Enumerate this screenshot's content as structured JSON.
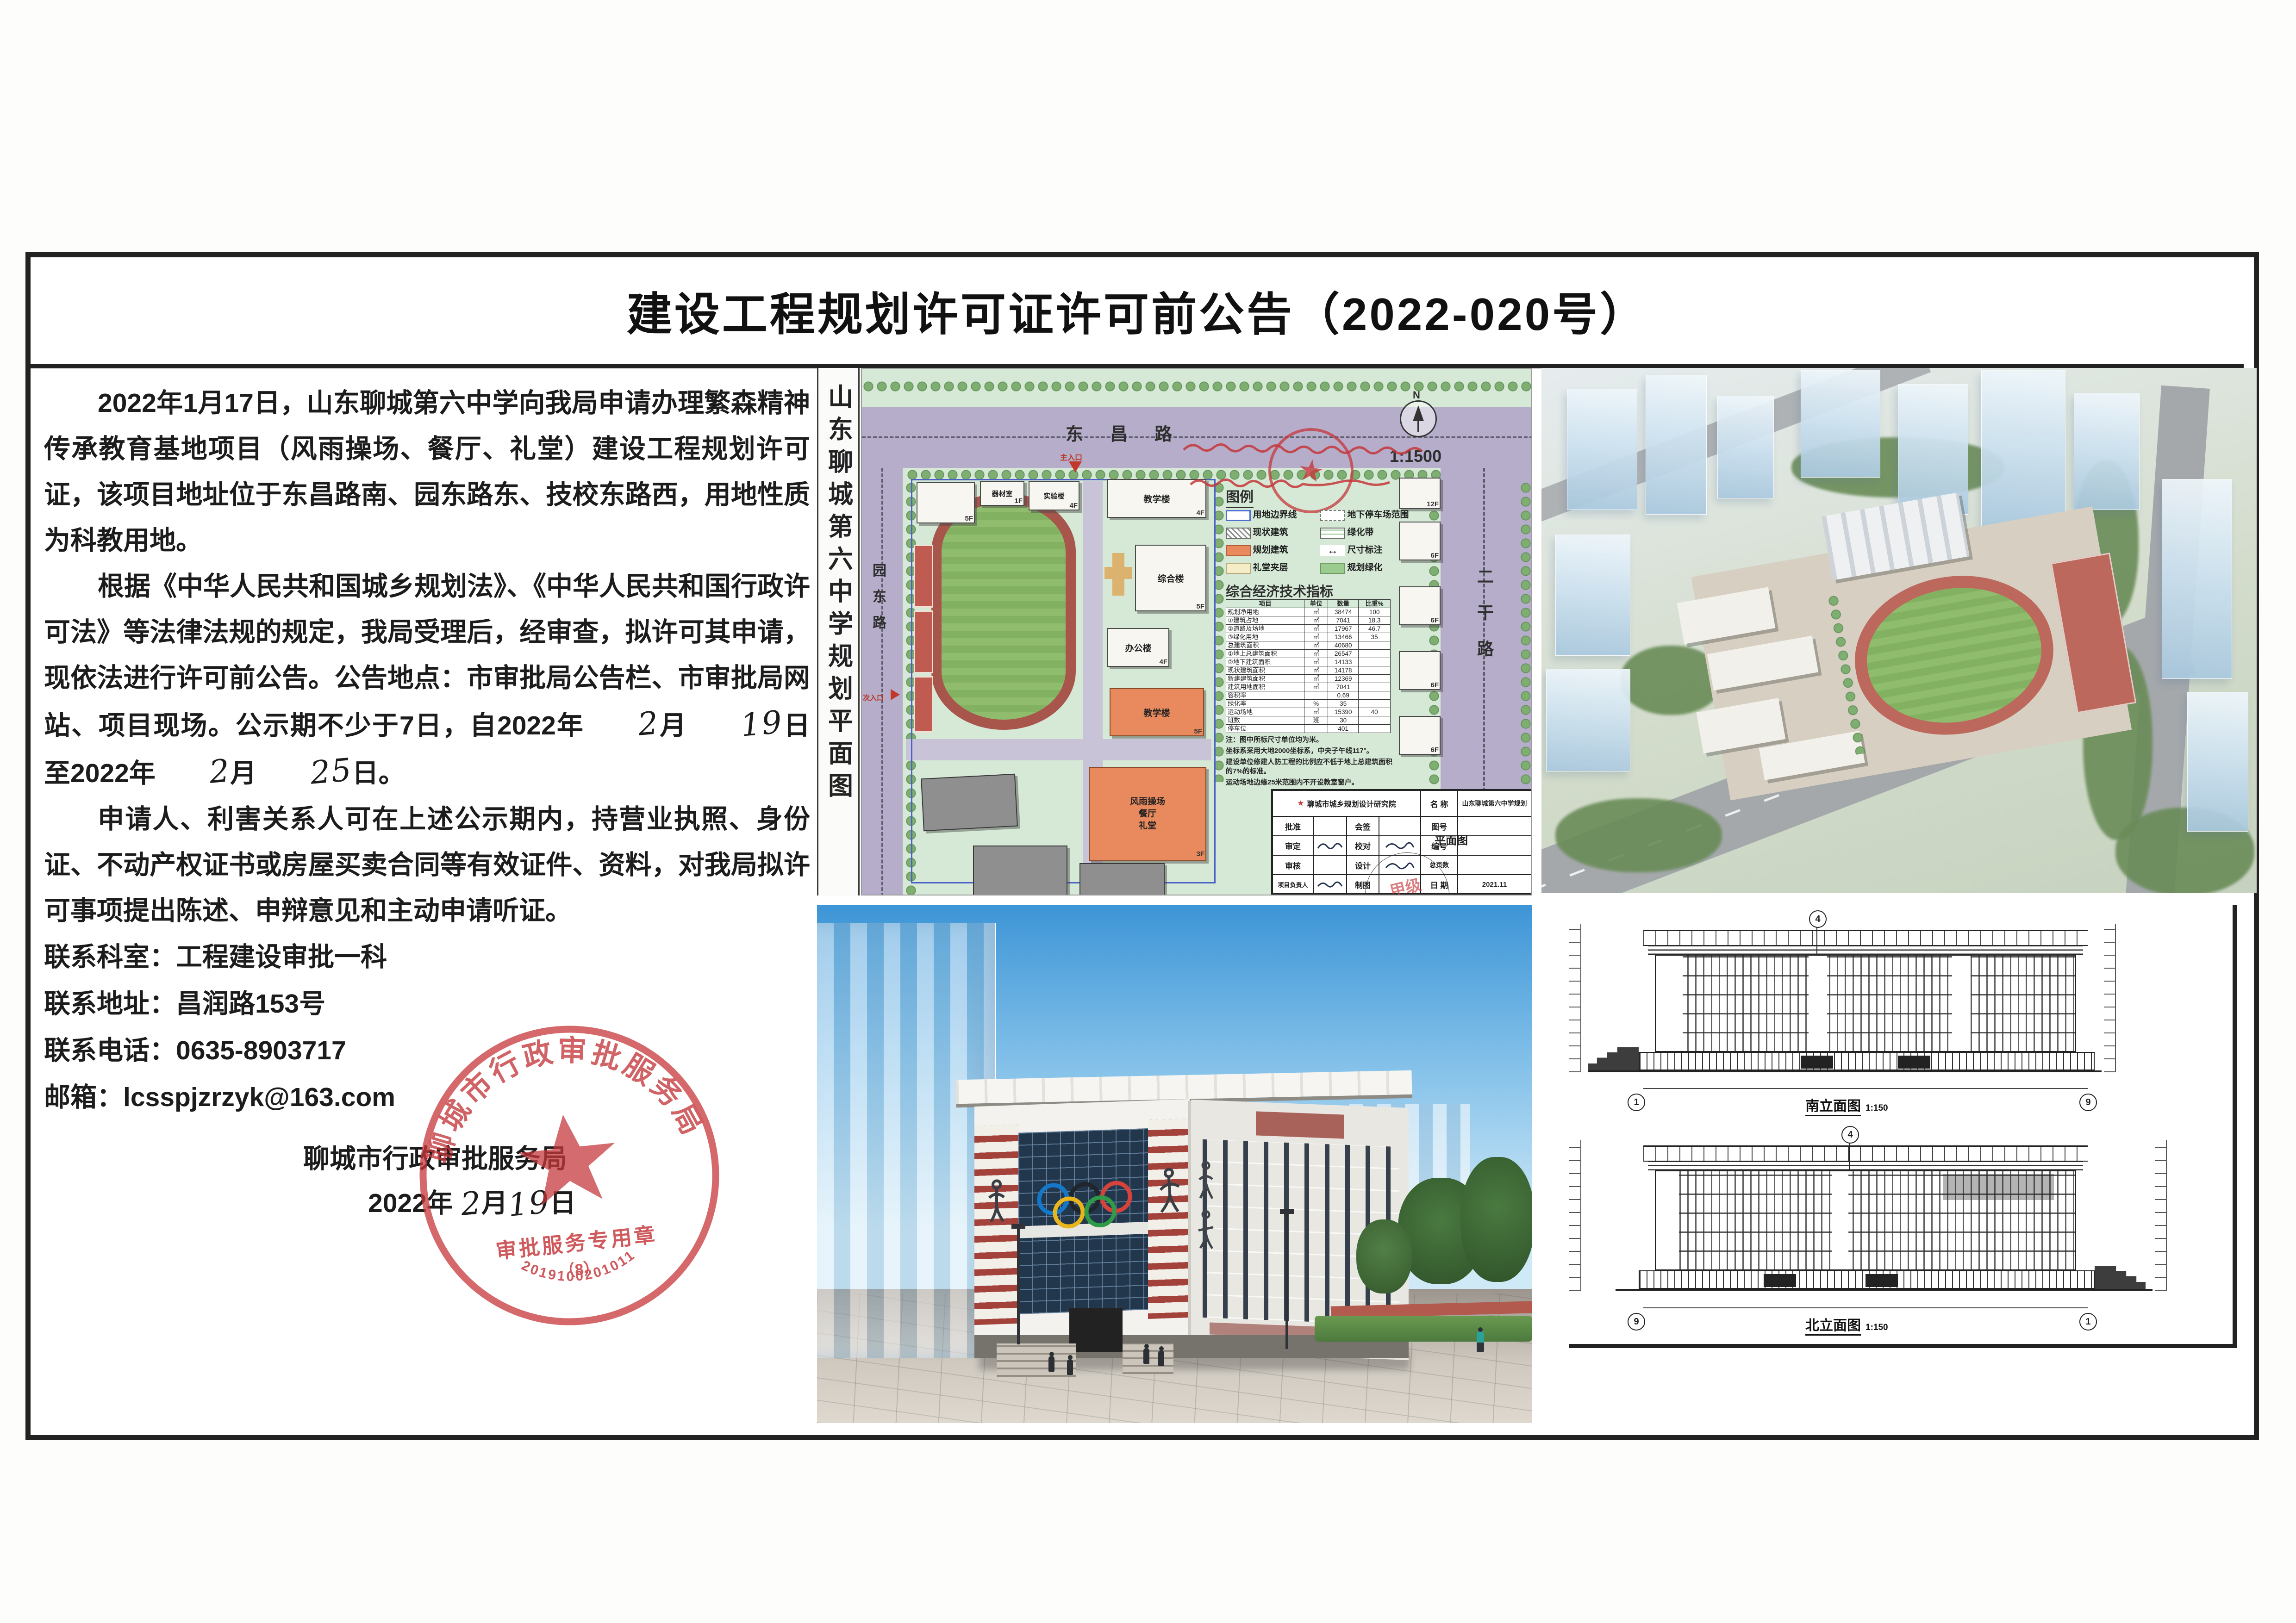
{
  "title": "建设工程规划许可证许可前公告（2022-020号）",
  "glyphs": {
    "north": "N",
    "star": "★",
    "dim_arrow": "↔"
  },
  "notice": {
    "paragraph1": "2022年1月17日，山东聊城第六中学向我局申请办理繁森精神传承教育基地项目（风雨操场、餐厅、礼堂）建设工程规划许可证，该项目地址位于东昌路南、园东路东、技校东路西，用地性质为科教用地。",
    "p2_pre": "根据《中华人民共和国城乡规划法》、《中华人民共和国行政许可法》等法律法规的规定，我局受理后，经审查，拟许可其申请，现依法进行许可前公告。公告地点：市审批局公告栏、市审批局网站、项目现场。公示期不少于7日，自2022年",
    "month1": "2",
    "month_char": "月",
    "day1": "19",
    "p2_mid": "日至2022年",
    "month2": "2",
    "day2": "25",
    "p2_end": "日。",
    "paragraph3": "申请人、利害关系人可在上述公示期内，持营业执照、身份证、不动产权证书或房屋买卖合同等有效证件、资料，对我局拟许可事项提出陈述、申辩意见和主动申请听证。",
    "contact1": "联系科室：工程建设审批一科",
    "contact2": "联系地址：昌润路153号",
    "contact3": "联系电话：0635-8903717",
    "contact4": "邮箱：lcsspjzrzyk@163.com",
    "sig_org": "聊城市行政审批服务局",
    "sig_year": "2022年",
    "sig_month": "2",
    "sig_month_char": "月",
    "sig_day": "19",
    "sig_day_char": "日"
  },
  "seal": {
    "org": "聊城市行政审批服务局",
    "line": "审批服务专用章",
    "no": "（8）",
    "code": "2019100201011"
  },
  "site_plan": {
    "vertical_title": "山东聊城第六中学规划平面图",
    "road_top": "东昌路",
    "road_left": "园东路",
    "road_right": "二干路",
    "scale": "1:1500",
    "main_entrance": "主入口",
    "secondary_entrance": "次入口",
    "legend_title": "图例",
    "legend": [
      "用地边界线",
      "地下停车场范围",
      "现状建筑",
      "绿化带",
      "规划建筑",
      "尺寸标注",
      "礼堂夹层",
      "规划绿化"
    ],
    "table_title": "综合经济技术指标",
    "headers": [
      "项目",
      "单位",
      "数量",
      "比重%"
    ],
    "rows": [
      [
        "规划净用地",
        "㎡",
        "38474",
        "100"
      ],
      [
        "①建筑占地",
        "㎡",
        "7041",
        "18.3"
      ],
      [
        "②道路及场地",
        "㎡",
        "17967",
        "46.7"
      ],
      [
        "③绿化用地",
        "㎡",
        "13466",
        "35"
      ],
      [
        "总建筑面积",
        "㎡",
        "40680",
        ""
      ],
      [
        "①地上总建筑面积",
        "㎡",
        "26547",
        ""
      ],
      [
        "②地下建筑面积",
        "㎡",
        "14133",
        ""
      ],
      [
        "现状建筑面积",
        "㎡",
        "14178",
        ""
      ],
      [
        "新建建筑面积",
        "㎡",
        "12369",
        ""
      ],
      [
        "建筑用地面积",
        "㎡",
        "7041",
        ""
      ],
      [
        "容积率",
        "",
        "0.69",
        ""
      ],
      [
        "绿化率",
        "%",
        "35",
        ""
      ],
      [
        "运动场地",
        "㎡",
        "15390",
        "40"
      ],
      [
        "班数",
        "班",
        "30",
        ""
      ],
      [
        "停车位",
        "",
        "401",
        ""
      ]
    ],
    "notes": [
      "注：图中所标尺寸单位均为米。",
      "坐标系采用大地2000坐标系，中央子午线117°。",
      "建设单位修建人防工程的比例应不低于地上总建筑面积的7%的标准。",
      "运动场地边缘25米范围内不开设教室窗户。"
    ],
    "bld_qicai": "器材室",
    "bld_shiyan": "实验楼",
    "bld_jiaoxue1": "教学楼",
    "bld_zonghe": "综合楼",
    "bld_bangong": "办公楼",
    "bld_jiaoxue2": "教学楼",
    "gym_line1": "风雨操场",
    "gym_line2": "餐厅",
    "gym_line3": "礼堂",
    "f1": "1F",
    "f3": "3F",
    "f4": "4F",
    "f5": "5F",
    "f6": "6F",
    "f12": "12F",
    "tb_institute": "聊城市城乡规划设计研究院",
    "tb_name_label": "名 称",
    "tb_project": "山东聊城第六中学规划",
    "tb_drawing": "平面图",
    "tb_grade": "甲级",
    "tb_r1c1": "批准",
    "tb_r1c2": "会签",
    "tb_r1c3": "图号",
    "tb_r2c1": "审定",
    "tb_r2c2": "校对",
    "tb_r2c3": "编号",
    "tb_r3c1": "审核",
    "tb_r3c2": "设计",
    "tb_r3c3": "总页数",
    "tb_r4c1": "项目负责人",
    "tb_r4c2": "制图",
    "tb_r4c3": "日 期",
    "tb_date": "2021.11"
  },
  "elevations": {
    "south_label": "南立面图",
    "north_label": "北立面图",
    "scale": "1:150",
    "axis1": "1",
    "axis9": "9",
    "axis4": "4"
  }
}
